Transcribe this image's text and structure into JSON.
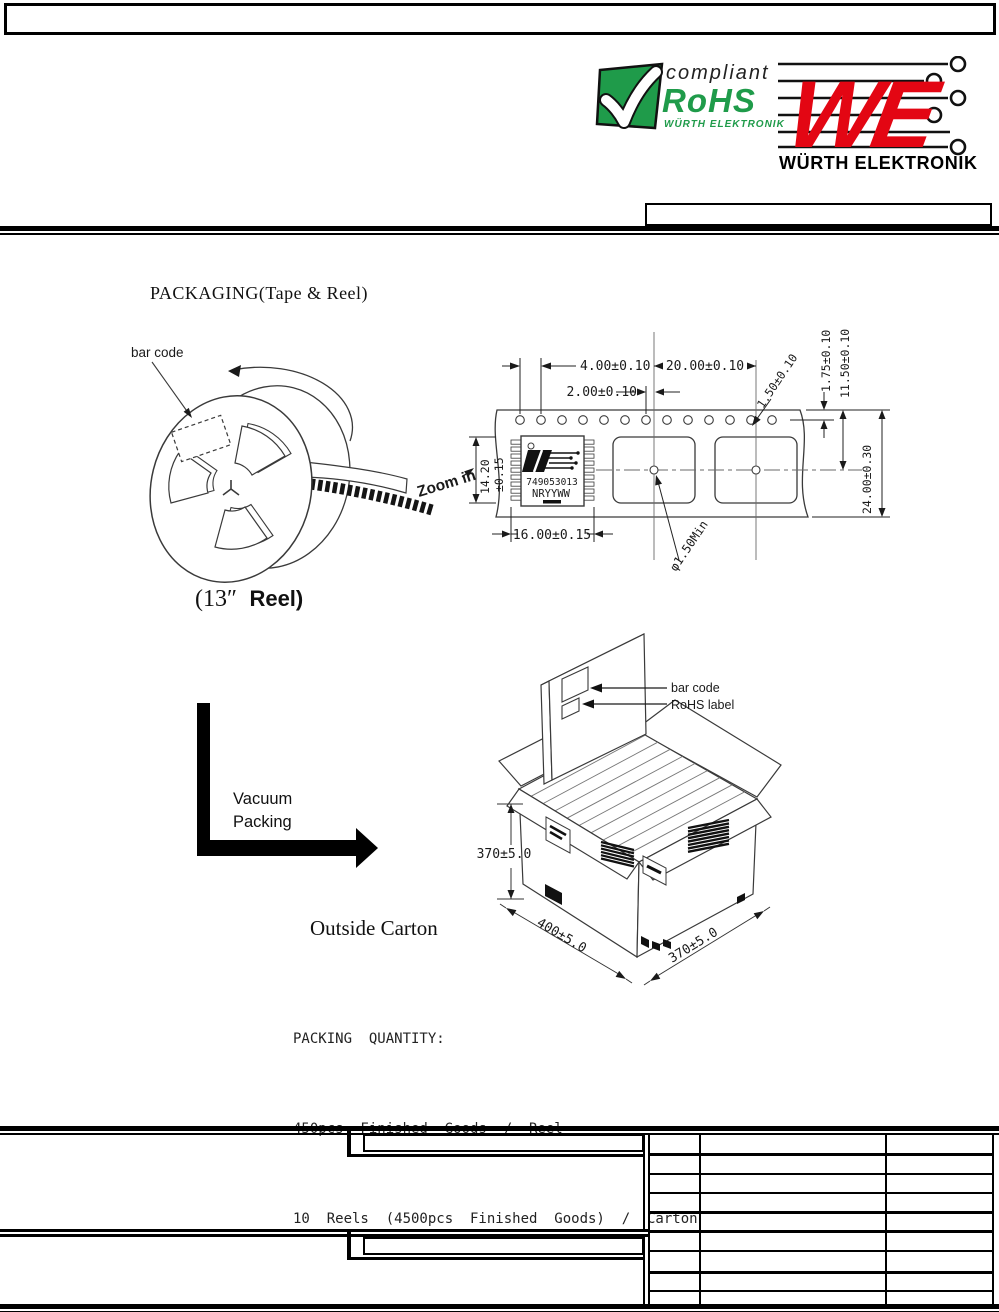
{
  "logos": {
    "rohs": {
      "compliant": "compliant",
      "name": "RoHS",
      "subtitle": "WÜRTH ELEKTRONIK"
    },
    "we": {
      "monogram": "WE",
      "name": "WÜRTH ELEKTRONIK"
    }
  },
  "title": "PACKAGING(Tape & Reel)",
  "reel_figure": {
    "bar_code": "bar code",
    "zoom_in": "Zoom in",
    "caption_open": "(13″",
    "caption_reel": "Reel)"
  },
  "tape_figure": {
    "dim_hole_pitch": "4.00±0.10",
    "dim_hole_to_pocket": "2.00±0.10",
    "dim_pocket_pitch": "20.00±0.10",
    "dim_hole_dia": "1.50±0.10",
    "dim_edge_to_hole": "1.75±0.10",
    "dim_edge_to_center": "11.50±0.10",
    "dim_tape_width": "24.00±0.30",
    "dim_pocket_len": "14.20",
    "dim_pocket_len_tol": "±0.15",
    "dim_pocket_width": "16.00±0.15",
    "dim_center_hole": "φ1.50Min",
    "component": {
      "part_number": "749053013",
      "date_code": "NRYYWW"
    }
  },
  "vacuum": {
    "line1": "Vacuum",
    "line2": "Packing"
  },
  "carton_figure": {
    "bar_code": "bar code",
    "rohs_label": "RoHS label",
    "dim_height": "370±5.0",
    "dim_width": "400±5.0",
    "dim_depth": "370±5.0",
    "caption": "Outside Carton"
  },
  "packing": {
    "title": "PACKING  QUANTITY:",
    "line1": "450pcs  Finished  Goods  /  Reel",
    "line2": "10  Reels  (4500pcs  Finished  Goods)  /  Carton"
  },
  "colors": {
    "rohs_green": "#1f9b4a",
    "we_red": "#e30613"
  }
}
